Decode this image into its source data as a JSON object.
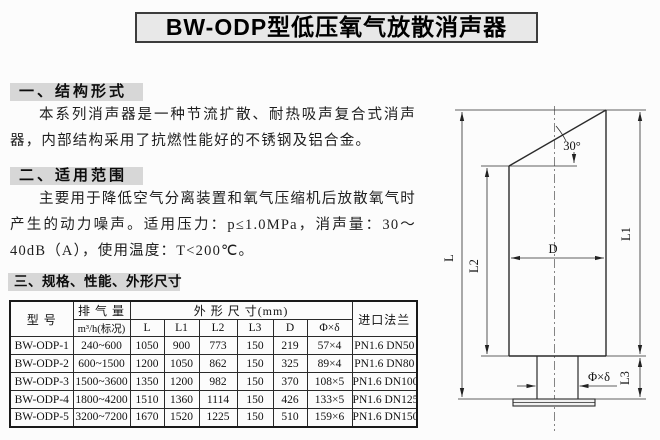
{
  "page": {
    "title": "BW-ODP型低压氧气放散消声器"
  },
  "sections": [
    {
      "heading": "一、结构形式",
      "body": "本系列消声器是一种节流扩散、耐热吸声复合式消声器，内部结构采用了抗燃性能好的不锈钢及铝合金。"
    },
    {
      "heading": "二、适用范围",
      "body": "主要用于降低空气分离装置和氧气压缩机后放散氧气时产生的动力噪声。适用压力：p≤1.0MPa，消声量：30～40dB（A），使用温度：T<200℃。"
    },
    {
      "heading": "三、规格、性能、外形尺寸"
    }
  ],
  "spec_table": {
    "col_model": "型  号",
    "col_flow_top": "排 气 量",
    "col_flow_bottom": "m³/h(标况)",
    "col_dims_group": "外 形 尺 寸(mm)",
    "col_dims": [
      "L",
      "L1",
      "L2",
      "L3",
      "D",
      "Φ×δ"
    ],
    "col_flange": "进口法兰",
    "rows": [
      {
        "model": "BW-ODP-1",
        "flow": "240~600",
        "L": "1050",
        "L1": "900",
        "L2": "773",
        "L3": "150",
        "D": "219",
        "phi": "57×4",
        "flange": "PN1.6 DN50"
      },
      {
        "model": "BW-ODP-2",
        "flow": "600~1500",
        "L": "1200",
        "L1": "1050",
        "L2": "862",
        "L3": "150",
        "D": "325",
        "phi": "89×4",
        "flange": "PN1.6 DN80"
      },
      {
        "model": "BW-ODP-3",
        "flow": "1500~3600",
        "L": "1350",
        "L1": "1200",
        "L2": "982",
        "L3": "150",
        "D": "370",
        "phi": "108×5",
        "flange": "PN1.6 DN100"
      },
      {
        "model": "BW-ODP-4",
        "flow": "1800~4200",
        "L": "1510",
        "L1": "1360",
        "L2": "1114",
        "L3": "150",
        "D": "426",
        "phi": "133×5",
        "flange": "PN1.6 DN125"
      },
      {
        "model": "BW-ODP-5",
        "flow": "3200~7200",
        "L": "1670",
        "L1": "1520",
        "L2": "1225",
        "L3": "150",
        "D": "510",
        "phi": "159×6",
        "flange": "PN1.6 DN150"
      }
    ]
  },
  "drawing": {
    "dim_L": "L",
    "dim_L1": "L1",
    "dim_L2": "L2",
    "dim_L3": "L3",
    "dim_D": "D",
    "dim_phi": "Φ×δ",
    "angle": "30°"
  },
  "colors": {
    "heading_bg": "#d7d7d7",
    "title_bg": "#e8e8e8",
    "border": "#1a1a1a",
    "page_bg": "#fcfcfc"
  }
}
